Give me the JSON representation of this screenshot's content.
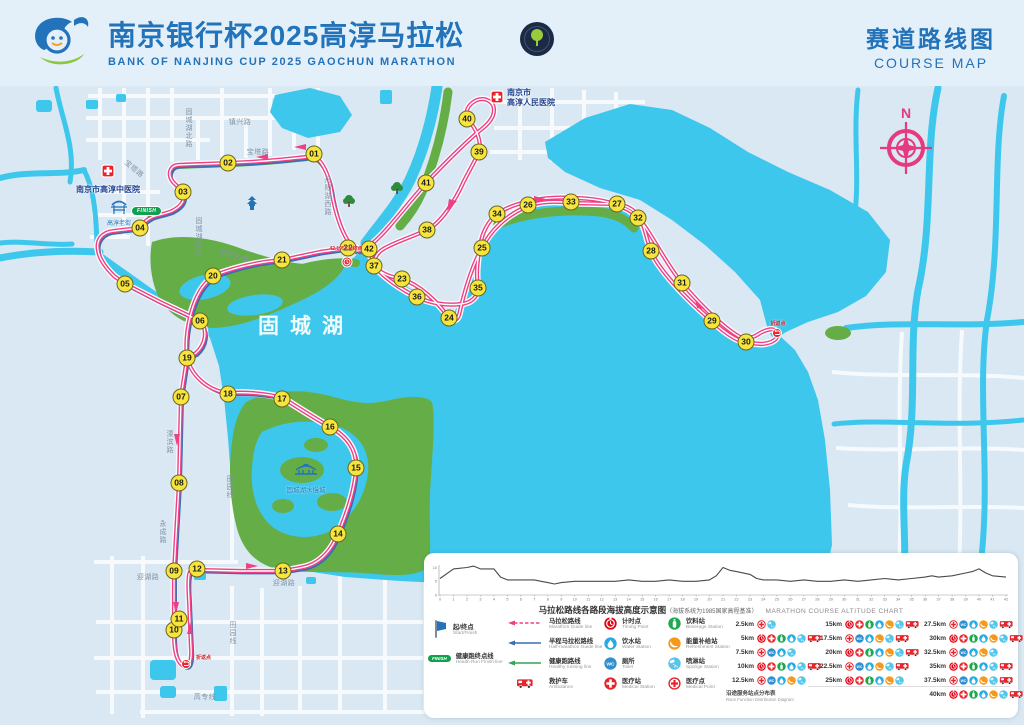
{
  "header": {
    "title_cn": "南京银行杯2025高淳马拉松",
    "title_en": "BANK OF NANJING CUP 2025 GAOCHUN MARATHON",
    "course_map_cn": "赛道路线图",
    "course_map_en": "COURSE MAP"
  },
  "map": {
    "compass_n": "N",
    "lake_label": "固城湖",
    "km_markers": [
      {
        "n": "01",
        "x": 314,
        "y": 154
      },
      {
        "n": "02",
        "x": 228,
        "y": 163
      },
      {
        "n": "03",
        "x": 183,
        "y": 192
      },
      {
        "n": "04",
        "x": 140,
        "y": 228
      },
      {
        "n": "05",
        "x": 125,
        "y": 284
      },
      {
        "n": "06",
        "x": 200,
        "y": 321
      },
      {
        "n": "07",
        "x": 181,
        "y": 397
      },
      {
        "n": "08",
        "x": 179,
        "y": 483
      },
      {
        "n": "09",
        "x": 174,
        "y": 571
      },
      {
        "n": "10",
        "x": 174,
        "y": 630
      },
      {
        "n": "11",
        "x": 179,
        "y": 619
      },
      {
        "n": "12",
        "x": 197,
        "y": 569
      },
      {
        "n": "13",
        "x": 283,
        "y": 571
      },
      {
        "n": "14",
        "x": 338,
        "y": 534
      },
      {
        "n": "15",
        "x": 356,
        "y": 468
      },
      {
        "n": "16",
        "x": 330,
        "y": 427
      },
      {
        "n": "17",
        "x": 282,
        "y": 399
      },
      {
        "n": "18",
        "x": 228,
        "y": 394
      },
      {
        "n": "19",
        "x": 187,
        "y": 358
      },
      {
        "n": "20",
        "x": 213,
        "y": 276
      },
      {
        "n": "21",
        "x": 282,
        "y": 260
      },
      {
        "n": "22",
        "x": 348,
        "y": 248
      },
      {
        "n": "23",
        "x": 402,
        "y": 279
      },
      {
        "n": "24",
        "x": 449,
        "y": 318
      },
      {
        "n": "25",
        "x": 482,
        "y": 248
      },
      {
        "n": "26",
        "x": 528,
        "y": 205
      },
      {
        "n": "27",
        "x": 617,
        "y": 204
      },
      {
        "n": "28",
        "x": 651,
        "y": 251
      },
      {
        "n": "29",
        "x": 712,
        "y": 321
      },
      {
        "n": "30",
        "x": 746,
        "y": 342
      },
      {
        "n": "31",
        "x": 682,
        "y": 283
      },
      {
        "n": "32",
        "x": 638,
        "y": 218
      },
      {
        "n": "33",
        "x": 571,
        "y": 202
      },
      {
        "n": "34",
        "x": 497,
        "y": 214
      },
      {
        "n": "35",
        "x": 478,
        "y": 288
      },
      {
        "n": "36",
        "x": 417,
        "y": 297
      },
      {
        "n": "37",
        "x": 374,
        "y": 266
      },
      {
        "n": "38",
        "x": 427,
        "y": 230
      },
      {
        "n": "39",
        "x": 479,
        "y": 152
      },
      {
        "n": "40",
        "x": 467,
        "y": 119
      },
      {
        "n": "41",
        "x": 426,
        "y": 183
      },
      {
        "n": "42",
        "x": 369,
        "y": 249
      }
    ],
    "labels": [
      {
        "text": "固城湖北路",
        "x": 188,
        "y": 128,
        "cls": "vert"
      },
      {
        "text": "镇兴路",
        "x": 240,
        "y": 122
      },
      {
        "text": "宝塔路",
        "x": 258,
        "y": 152
      },
      {
        "text": "宝塔路",
        "x": 134,
        "y": 169,
        "cls": "rot40"
      },
      {
        "text": "固城湖南路",
        "x": 198,
        "y": 237,
        "cls": "vert"
      },
      {
        "text": "湖滨大道",
        "x": 234,
        "y": 256,
        "cls": "rot18"
      },
      {
        "text": "丹阳湖西路",
        "x": 327,
        "y": 196,
        "cls": "vert"
      },
      {
        "text": "溧滨路",
        "x": 169,
        "y": 442,
        "cls": "vert"
      },
      {
        "text": "永成路",
        "x": 162,
        "y": 532,
        "cls": "vert"
      },
      {
        "text": "田园线",
        "x": 229,
        "y": 487,
        "cls": "vert"
      },
      {
        "text": "田园线",
        "x": 232,
        "y": 633,
        "cls": "vert"
      },
      {
        "text": "迎湖路",
        "x": 148,
        "y": 577
      },
      {
        "text": "迎湖路",
        "x": 284,
        "y": 583
      },
      {
        "text": "高专线",
        "x": 205,
        "y": 697
      }
    ],
    "poi": {
      "hospital_tcm": "南京市高淳中医院",
      "hospital_people_l1": "南京市",
      "hospital_people_l2": "高淳人民医院",
      "old_street": "高淳老街",
      "water_town": "固城湖水慢城",
      "finish_pill": "FINISH",
      "finish_point": "42.195KM终点",
      "turn_label": "折返点"
    }
  },
  "chart_data": {
    "type": "line",
    "title_cn": "马拉松路线各路段海拔高度示意图",
    "title_note": "（海拔系统为1985国家高程基准）",
    "title_en": "MARATHON COURSE ALTITUDE CHART",
    "xlabel": "km",
    "ylabel": "m",
    "ylim": [
      0,
      12
    ],
    "y_ticks": [
      0,
      5,
      10
    ],
    "x_ticks": [
      0,
      1,
      2,
      3,
      4,
      5,
      6,
      7,
      8,
      9,
      10,
      11,
      12,
      13,
      14,
      15,
      16,
      17,
      18,
      19,
      20,
      21,
      22,
      23,
      24,
      25,
      26,
      27,
      28,
      29,
      30,
      31,
      32,
      33,
      34,
      35,
      36,
      37,
      38,
      39,
      40,
      41,
      42
    ],
    "km": [
      0,
      1,
      2,
      2.5,
      3,
      4,
      4.5,
      5,
      6,
      7,
      7.5,
      8,
      8.5,
      9,
      10,
      11,
      12,
      13,
      14,
      15,
      16,
      17,
      18,
      19,
      20,
      20.5,
      21,
      21.5,
      22,
      23,
      23.5,
      24,
      25,
      26,
      27,
      28,
      29,
      30,
      31,
      32,
      33,
      34,
      35,
      36,
      36.5,
      37,
      38,
      39,
      39.5,
      40,
      40.5,
      41,
      42
    ],
    "elevation_m": [
      6,
      9.5,
      10,
      10.5,
      9.5,
      9.5,
      6.5,
      5.5,
      5.5,
      5.5,
      5,
      4.5,
      4,
      4.5,
      5,
      5,
      5,
      5,
      5.5,
      5,
      5,
      5.5,
      5,
      5,
      5.5,
      7,
      10,
      9,
      8.5,
      7.5,
      6,
      5.5,
      5.5,
      5,
      5.5,
      5,
      5,
      5.5,
      5,
      5.5,
      6,
      5.5,
      6,
      6.5,
      7,
      6.5,
      7,
      8,
      8.5,
      9.5,
      8,
      7,
      6.5
    ]
  },
  "legend": {
    "start_finish": {
      "cn": "起/终点",
      "en": "Start/Finish"
    },
    "health_finish": {
      "cn": "健康跑终点线",
      "en": "Health Run Finish line",
      "pill": "FINISH"
    },
    "lines": [
      {
        "type": "marathon",
        "color": "#ee4085",
        "cn": "马拉松路线",
        "en": "Marathon Guide line"
      },
      {
        "type": "half",
        "color": "#3a6db2",
        "cn": "半程马拉松路线",
        "en": "Half-marathon Guide line"
      },
      {
        "type": "health",
        "color": "#33a455",
        "cn": "健康跑路线",
        "en": "Healthy running line"
      },
      {
        "type": "ambulance",
        "color": "#e8232a",
        "cn": "救护车",
        "en": "Ambulance"
      }
    ],
    "icons_a": [
      {
        "type": "timing",
        "cn": "计时点",
        "en": "Timing Point"
      },
      {
        "type": "water",
        "cn": "饮水站",
        "en": "Water Station"
      },
      {
        "type": "toilet",
        "cn": "厕所",
        "en": "Toilet"
      },
      {
        "type": "medical",
        "cn": "医疗站",
        "en": "Medical Station"
      }
    ],
    "icons_b": [
      {
        "type": "beverage",
        "cn": "饮料站",
        "en": "Beverage Station"
      },
      {
        "type": "refreshment",
        "cn": "能量补给站",
        "en": "Refreshment Station"
      },
      {
        "type": "sponge",
        "cn": "喷淋站",
        "en": "Sponge Station"
      },
      {
        "type": "medicalpoint",
        "cn": "医疗点",
        "en": "Medical Point"
      }
    ],
    "stations_note_cn": "沿途服务站点分布表",
    "stations_note_en": "Race Function Distribution Diagram",
    "station_cols": [
      [
        {
          "km": "2.5km",
          "icons": [
            "medicalpoint",
            "sponge"
          ]
        },
        {
          "km": "5km",
          "icons": [
            "timing",
            "medical",
            "beverage",
            "water",
            "sponge",
            "ambulance"
          ]
        },
        {
          "km": "7.5km",
          "icons": [
            "medicalpoint",
            "toilet",
            "water",
            "sponge"
          ]
        },
        {
          "km": "10km",
          "icons": [
            "timing",
            "medical",
            "beverage",
            "water",
            "sponge",
            "ambulance"
          ]
        },
        {
          "km": "12.5km",
          "icons": [
            "medicalpoint",
            "toilet",
            "water",
            "refreshment",
            "sponge"
          ]
        }
      ],
      [
        {
          "km": "15km",
          "icons": [
            "timing",
            "medical",
            "beverage",
            "water",
            "refreshment",
            "sponge",
            "ambulance"
          ]
        },
        {
          "km": "17.5km",
          "icons": [
            "medicalpoint",
            "toilet",
            "water",
            "refreshment",
            "sponge",
            "ambulance"
          ]
        },
        {
          "km": "20km",
          "icons": [
            "timing",
            "medical",
            "beverage",
            "water",
            "refreshment",
            "sponge",
            "ambulance"
          ]
        },
        {
          "km": "22.5km",
          "icons": [
            "medicalpoint",
            "toilet",
            "water",
            "refreshment",
            "sponge",
            "ambulance"
          ]
        },
        {
          "km": "25km",
          "icons": [
            "timing",
            "medical",
            "beverage",
            "water",
            "refreshment",
            "sponge"
          ]
        }
      ],
      [
        {
          "km": "27.5km",
          "icons": [
            "medicalpoint",
            "toilet",
            "water",
            "refreshment",
            "sponge",
            "ambulance"
          ]
        },
        {
          "km": "30km",
          "icons": [
            "timing",
            "medical",
            "beverage",
            "water",
            "refreshment",
            "sponge",
            "ambulance"
          ]
        },
        {
          "km": "32.5km",
          "icons": [
            "medicalpoint",
            "toilet",
            "water",
            "refreshment",
            "sponge"
          ]
        },
        {
          "km": "35km",
          "icons": [
            "timing",
            "medical",
            "beverage",
            "water",
            "sponge",
            "ambulance"
          ]
        },
        {
          "km": "37.5km",
          "icons": [
            "medicalpoint",
            "toilet",
            "water",
            "refreshment",
            "sponge",
            "ambulance"
          ]
        },
        {
          "km": "40km",
          "icons": [
            "timing",
            "medical",
            "beverage",
            "water",
            "refreshment",
            "sponge",
            "ambulance"
          ]
        }
      ]
    ]
  }
}
